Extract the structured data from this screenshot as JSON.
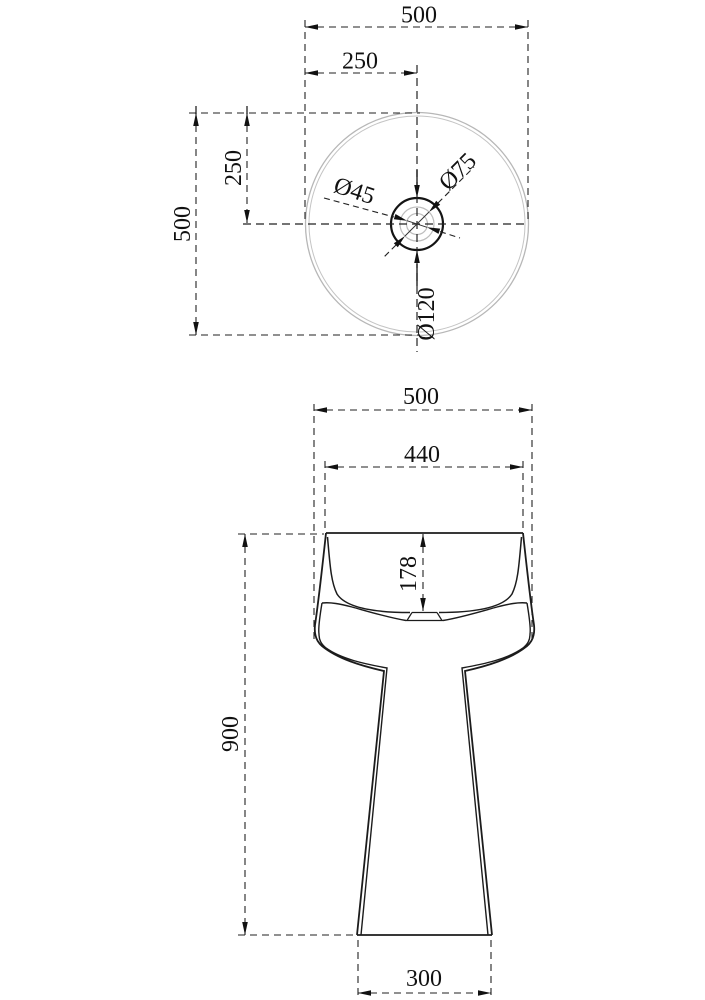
{
  "drawing": {
    "background": "#ffffff",
    "line_color": "#1c1c1c",
    "light_line_color": "#b7b7b7",
    "top_view": {
      "width_total": "500",
      "width_to_center": "250",
      "height_to_center": "250",
      "height_total": "500",
      "diameter_small": "Ø45",
      "diameter_medium": "Ø75",
      "diameter_large": "Ø120"
    },
    "front_view": {
      "width_total": "500",
      "width_rim": "440",
      "basin_depth": "178",
      "height_total": "900",
      "base_width": "300"
    }
  }
}
